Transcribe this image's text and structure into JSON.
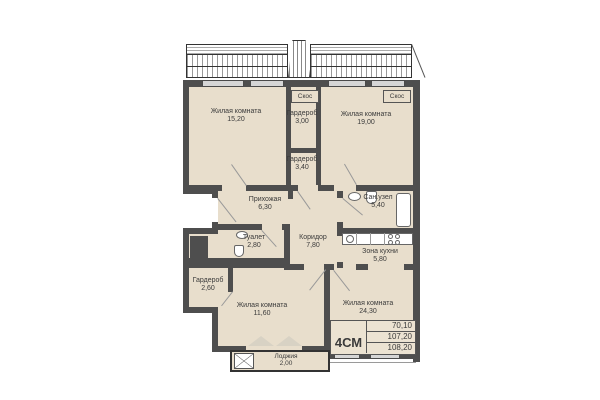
{
  "rooms": [
    {
      "name": "Жилая комната",
      "area": "15,20"
    },
    {
      "name": "Гардероб",
      "area": "3,00"
    },
    {
      "name": "Жилая комната",
      "area": "19,00"
    },
    {
      "name": "Гардероб",
      "area": "3,40"
    },
    {
      "name": "Прихожая",
      "area": "6,30"
    },
    {
      "name": "Сан.узел",
      "area": "5,40"
    },
    {
      "name": "Туалет",
      "area": "2,80"
    },
    {
      "name": "Коридор",
      "area": "7,80"
    },
    {
      "name": "Зона кухни",
      "area": "5,80"
    },
    {
      "name": "Гардероб",
      "area": "2,60"
    },
    {
      "name": "Жилая комната",
      "area": "11,60"
    },
    {
      "name": "Жилая комната",
      "area": "24,30"
    },
    {
      "name": "Лоджия",
      "area": "2,00"
    }
  ],
  "slopes": [
    "Скос",
    "Скос"
  ],
  "stamp": {
    "type": "4СМ",
    "values": [
      "70,10",
      "107,20",
      "108,20"
    ]
  },
  "colors": {
    "floor": "#e8decc",
    "wall": "#4e4e4e",
    "window": "#d6d6d6"
  }
}
